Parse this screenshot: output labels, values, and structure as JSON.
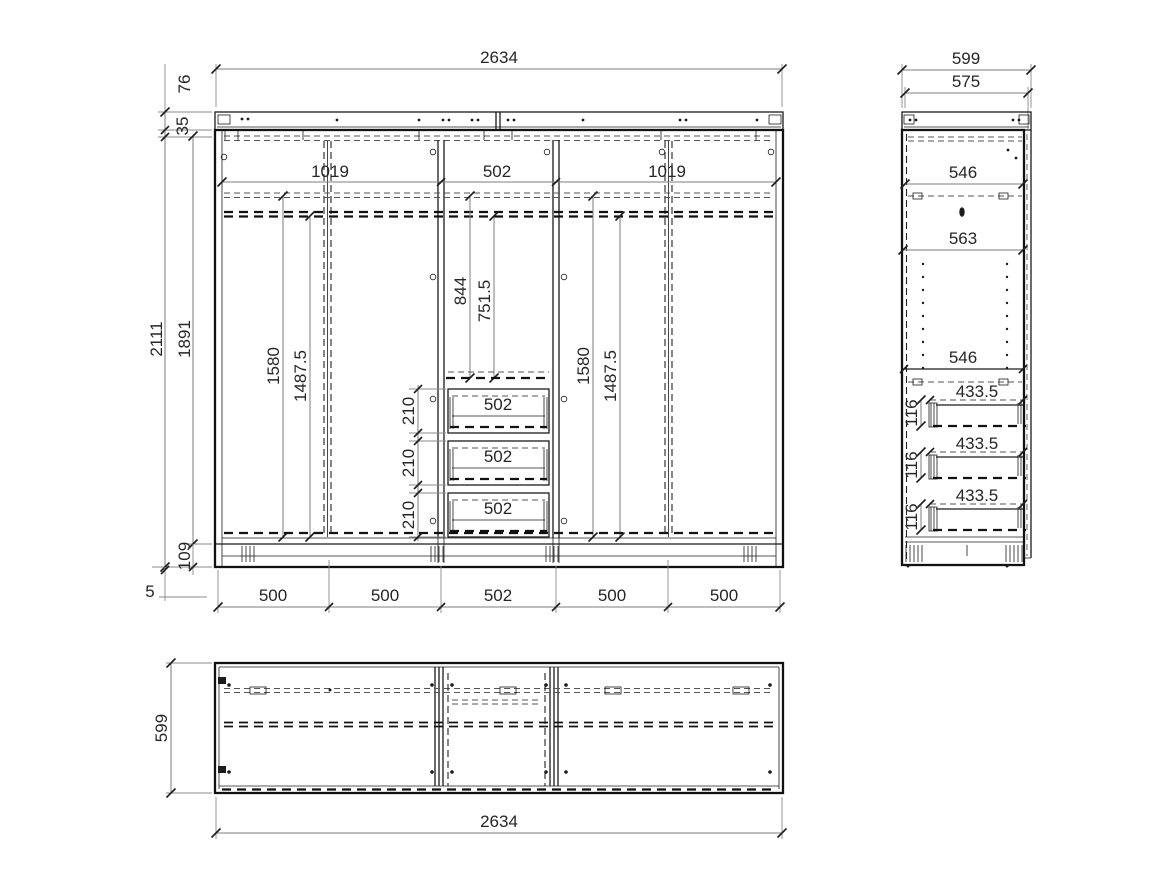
{
  "drawing": {
    "front": {
      "width_total": "2634",
      "cornice_height": "76",
      "top_panel_thickness": "35",
      "height_total": "2111",
      "height_interior": "1891",
      "base_height": "109",
      "plinth_offset": "5",
      "section_widths": [
        "1019",
        "502",
        "1019"
      ],
      "left_heights": [
        "1580",
        "1487.5"
      ],
      "center_heights": [
        "844",
        "751.5"
      ],
      "right_heights": [
        "1580",
        "1487.5"
      ],
      "drawer_pitches": [
        "210",
        "210",
        "210"
      ],
      "drawer_widths": [
        "502",
        "502",
        "502"
      ],
      "bay_widths": [
        "500",
        "500",
        "502",
        "500",
        "500"
      ]
    },
    "side": {
      "depth_total": "599",
      "depth_body": "575",
      "depth_top": "546",
      "depth_middle": "563",
      "depth_shelf": "546",
      "drawer_depths": [
        "433.5",
        "433.5",
        "433.5"
      ],
      "drawer_side_heights": [
        "116",
        "116",
        "116"
      ]
    },
    "plan": {
      "depth": "599",
      "width": "2634"
    },
    "colors": {
      "line": "#1b1b1b",
      "dimension": "#7d7d7d",
      "text": "#262626",
      "background": "#ffffff"
    }
  }
}
